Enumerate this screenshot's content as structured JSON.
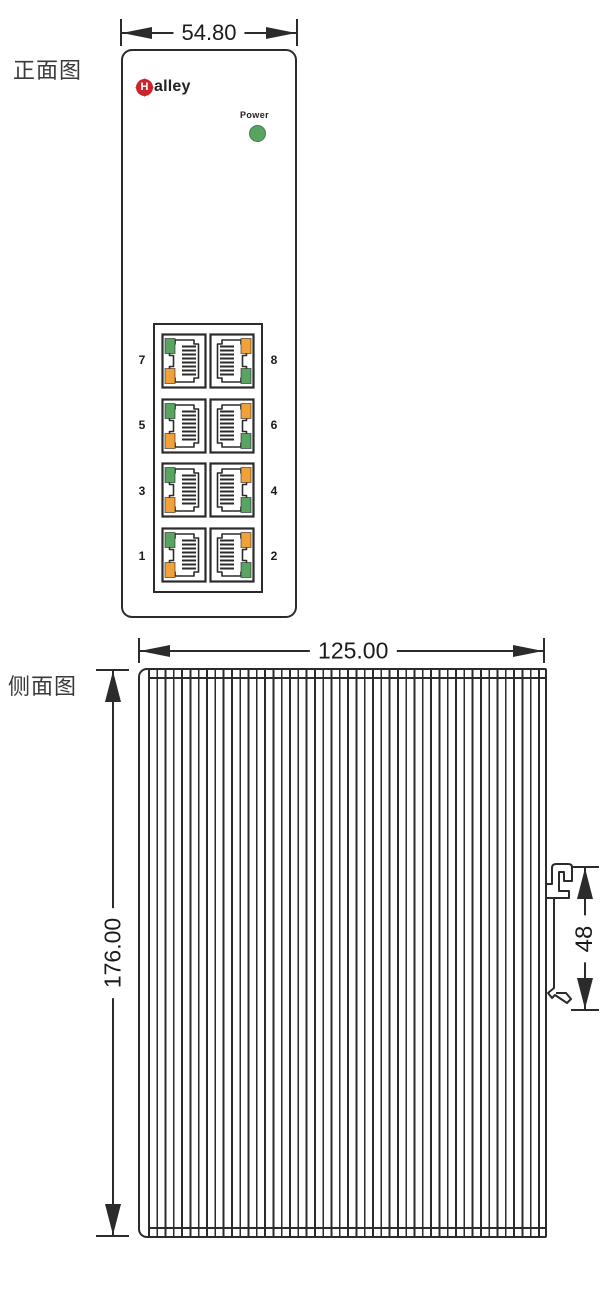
{
  "front_view": {
    "label": "正面图",
    "width_dim": "54.80",
    "logo": {
      "symbol": "H",
      "text": "alley"
    },
    "power_label": "Power",
    "port_rows": [
      {
        "left": "7",
        "right": "8"
      },
      {
        "left": "5",
        "right": "6"
      },
      {
        "left": "3",
        "right": "4"
      },
      {
        "left": "1",
        "right": "2"
      }
    ]
  },
  "side_view": {
    "label": "侧面图",
    "width_dim": "125.00",
    "height_dim": "176.00",
    "din_clip_dim": "48"
  },
  "colors": {
    "line": "#2b2b2b",
    "led_green": "#5aa463",
    "led_orange": "#f2a13a",
    "logo_red": "#c9252c"
  }
}
